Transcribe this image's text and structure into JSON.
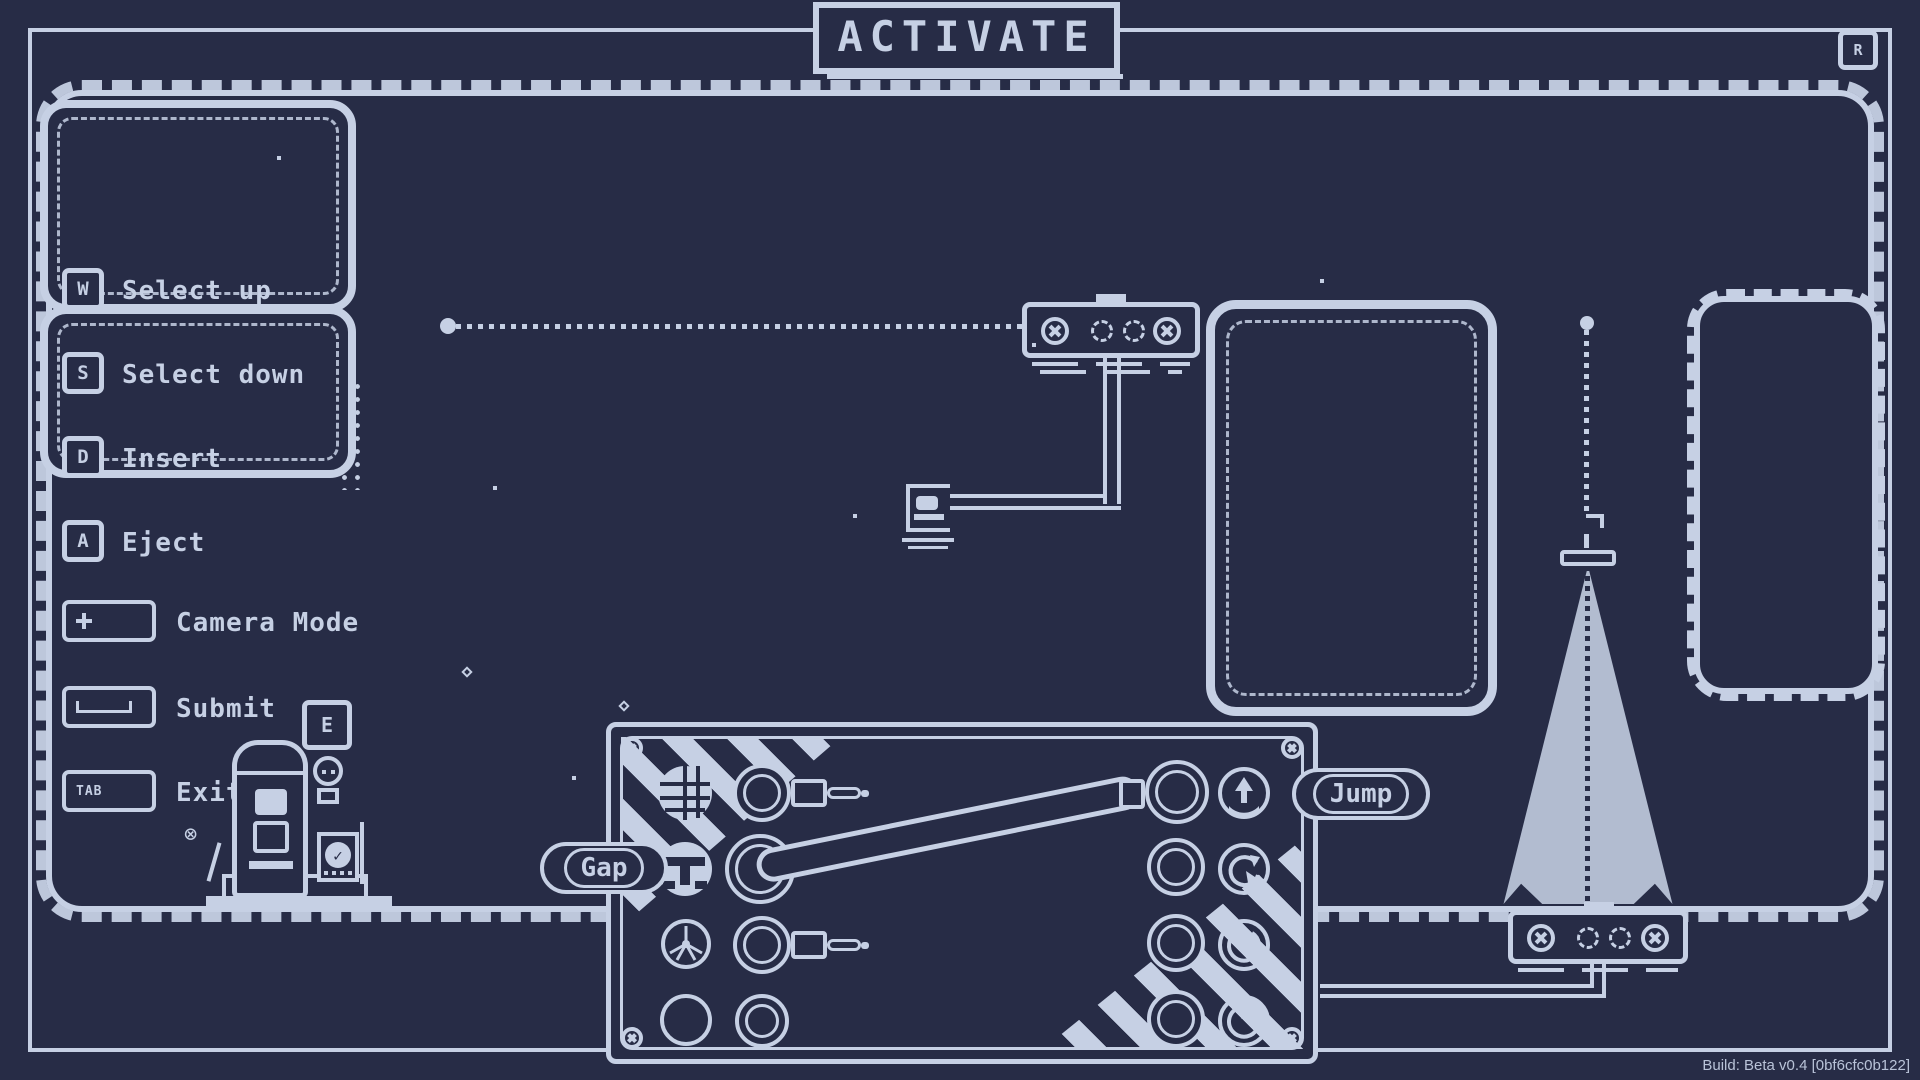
{
  "title": "ACTIVATE",
  "top_right_key": "R",
  "legend": {
    "items": [
      {
        "key": "W",
        "label": "Select up"
      },
      {
        "key": "S",
        "label": "Select down"
      },
      {
        "key": "D",
        "label": "Insert"
      },
      {
        "key": "A",
        "label": "Eject"
      },
      {
        "key": "+",
        "label": "Camera Mode"
      },
      {
        "key": "SPACE",
        "label": "Submit"
      },
      {
        "key": "TAB",
        "label": "Exit"
      }
    ]
  },
  "machine": {
    "interact_key": "E"
  },
  "panel": {
    "gap_label": "Gap",
    "jump_label": "Jump",
    "dials": [
      "globe-dial",
      "tee-dial",
      "fan-dial",
      "empty-dial"
    ],
    "jacks": [
      "jack-plug",
      "pipe-source-socket",
      "jack-plug",
      "empty-socket"
    ],
    "sockets": [
      "pipe-connected-socket",
      "empty-socket",
      "empty-socket",
      "empty-socket"
    ],
    "buttons": [
      "eject-up-button",
      "rotate-button",
      "power-button",
      "power-button"
    ]
  },
  "build": "Build: Beta v0.4 [0bf6cfc0b122]",
  "colors": {
    "background": "#272c46",
    "foreground": "#c6d0e4",
    "build_text": "#b9c3d8"
  }
}
